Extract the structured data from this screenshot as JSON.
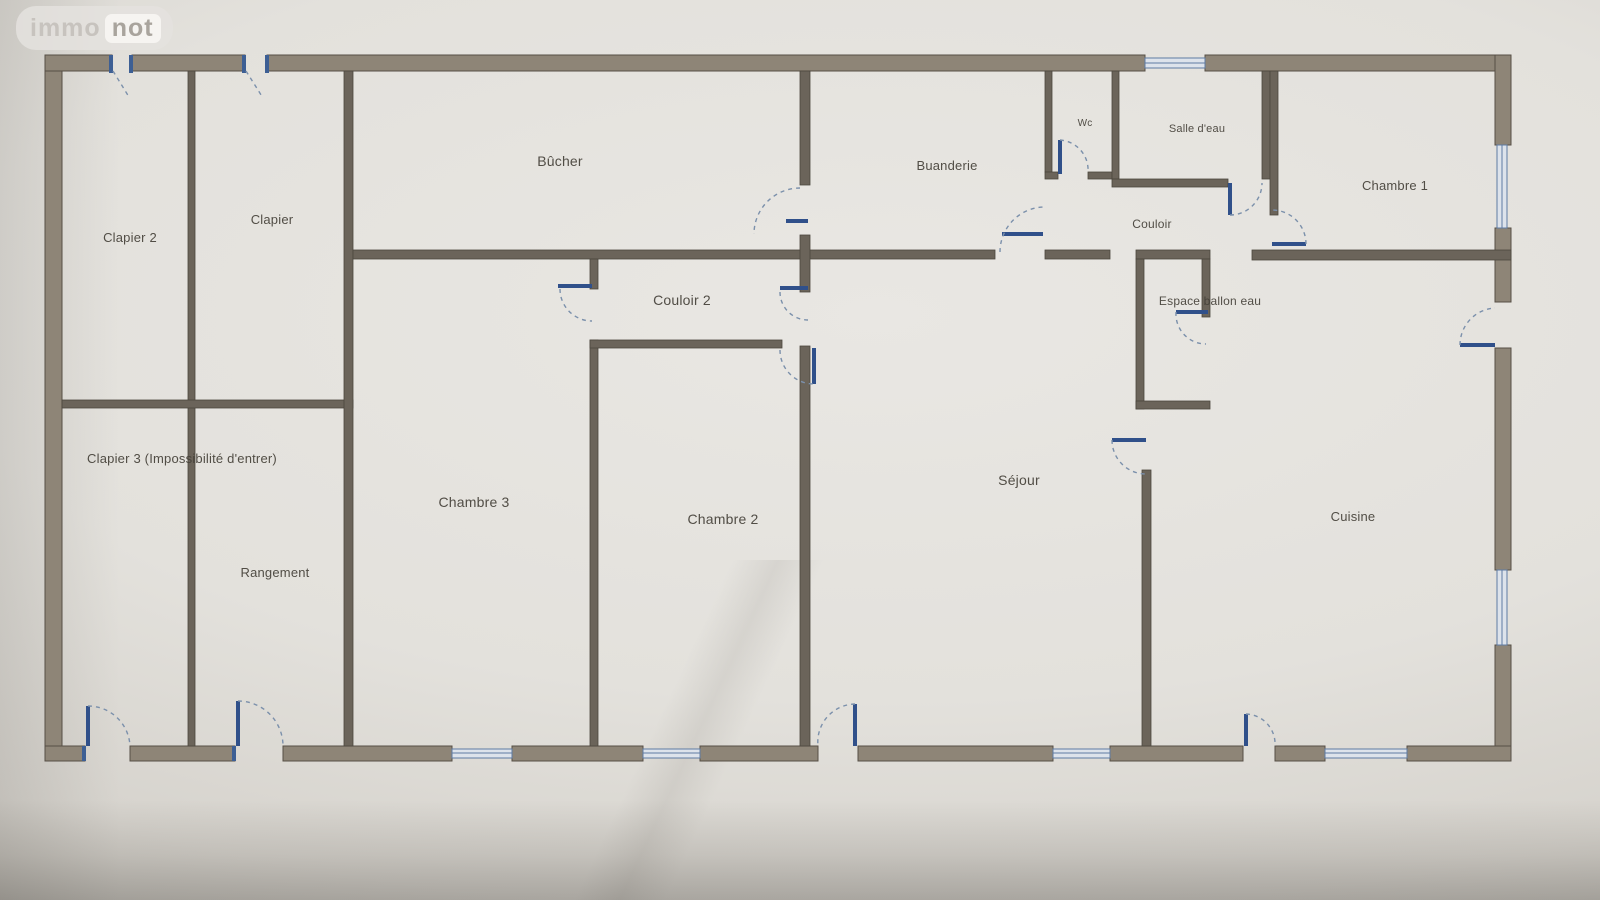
{
  "logo": {
    "immo": "immo",
    "not": "not"
  },
  "rooms": [
    {
      "id": "clapier-2",
      "label": "Clapier 2"
    },
    {
      "id": "clapier",
      "label": "Clapier"
    },
    {
      "id": "bucher",
      "label": "Bûcher"
    },
    {
      "id": "buanderie",
      "label": "Buanderie"
    },
    {
      "id": "wc",
      "label": "Wc"
    },
    {
      "id": "salle-deau",
      "label": "Salle d'eau"
    },
    {
      "id": "chambre-1",
      "label": "Chambre 1"
    },
    {
      "id": "couloir",
      "label": "Couloir"
    },
    {
      "id": "couloir-2",
      "label": "Couloir 2"
    },
    {
      "id": "espace-ballon-eau",
      "label": "Espace ballon eau"
    },
    {
      "id": "clapier-3",
      "label": "Clapier 3 (Impossibilité d'entrer)"
    },
    {
      "id": "chambre-3",
      "label": "Chambre 3"
    },
    {
      "id": "chambre-2",
      "label": "Chambre 2"
    },
    {
      "id": "sejour",
      "label": "Séjour"
    },
    {
      "id": "rangement",
      "label": "Rangement"
    },
    {
      "id": "cuisine",
      "label": "Cuisine"
    }
  ],
  "colors": {
    "paper": "#e3e1dc",
    "wall_exterior": "#8e8577",
    "wall_interior": "#6b645a",
    "door_leaf": "#30508a",
    "door_arc": "#7b90ab",
    "window": "#5e7ba3",
    "label_text": "#454139"
  }
}
